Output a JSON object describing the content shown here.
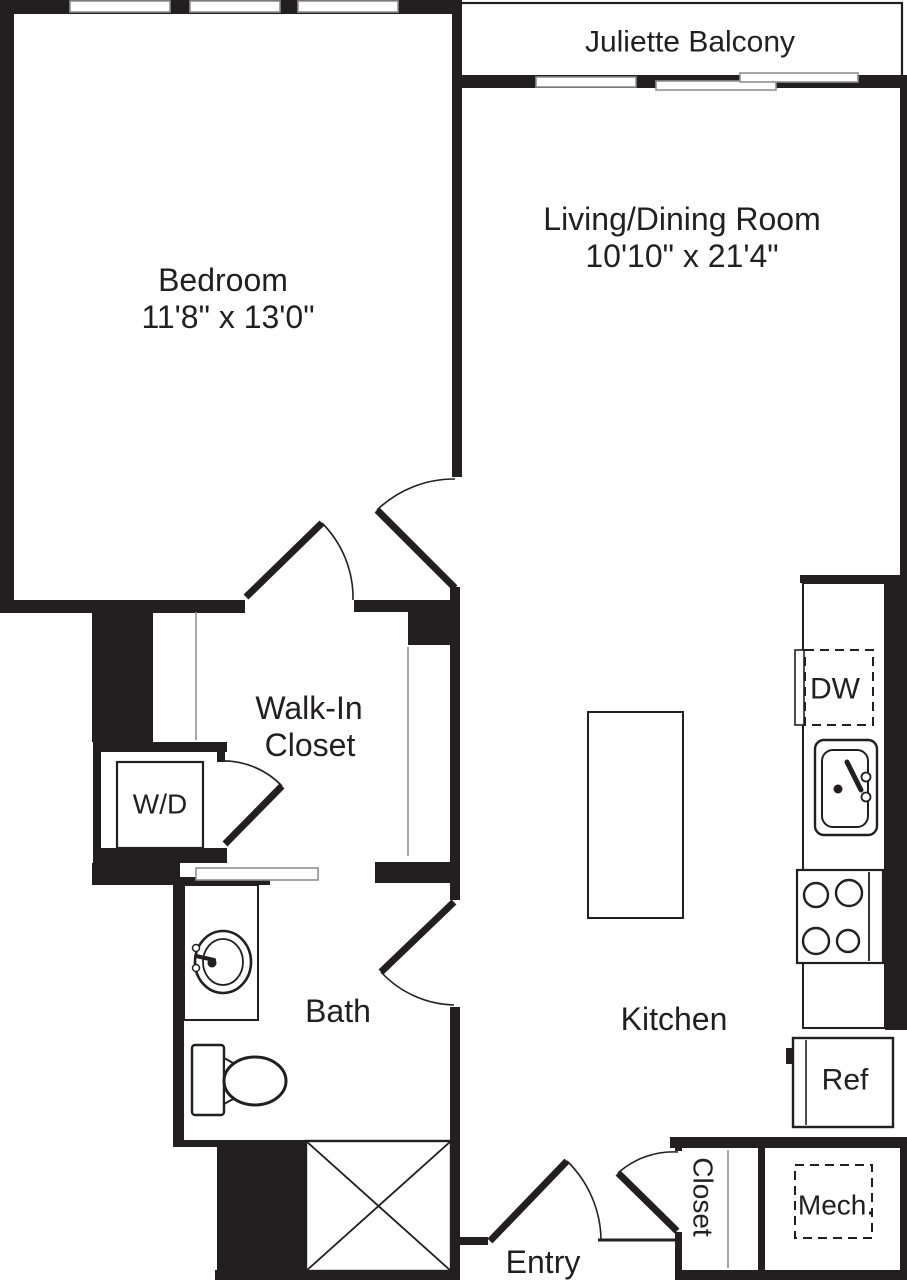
{
  "colors": {
    "wall": "#231f20",
    "line": "#231f20",
    "text": "#231f20",
    "window_outline": "#8d9094",
    "background": "#ffffff"
  },
  "rooms": {
    "balcony": {
      "label": "Juliette Balcony"
    },
    "living_dining": {
      "label": "Living/Dining Room",
      "dimensions": "10'10\" x 21'4\""
    },
    "bedroom": {
      "label": "Bedroom",
      "dimensions": "11'8\" x 13'0\""
    },
    "walk_in_closet": {
      "label_line1": "Walk-In",
      "label_line2": "Closet"
    },
    "bath": {
      "label": "Bath"
    },
    "kitchen": {
      "label": "Kitchen"
    },
    "entry": {
      "label": "Entry"
    },
    "entry_closet": {
      "label": "Closet"
    },
    "mech": {
      "label": "Mech."
    }
  },
  "appliances": {
    "washer_dryer": {
      "label": "W/D"
    },
    "dishwasher": {
      "label": "DW"
    },
    "refrigerator": {
      "label": "Ref"
    }
  }
}
